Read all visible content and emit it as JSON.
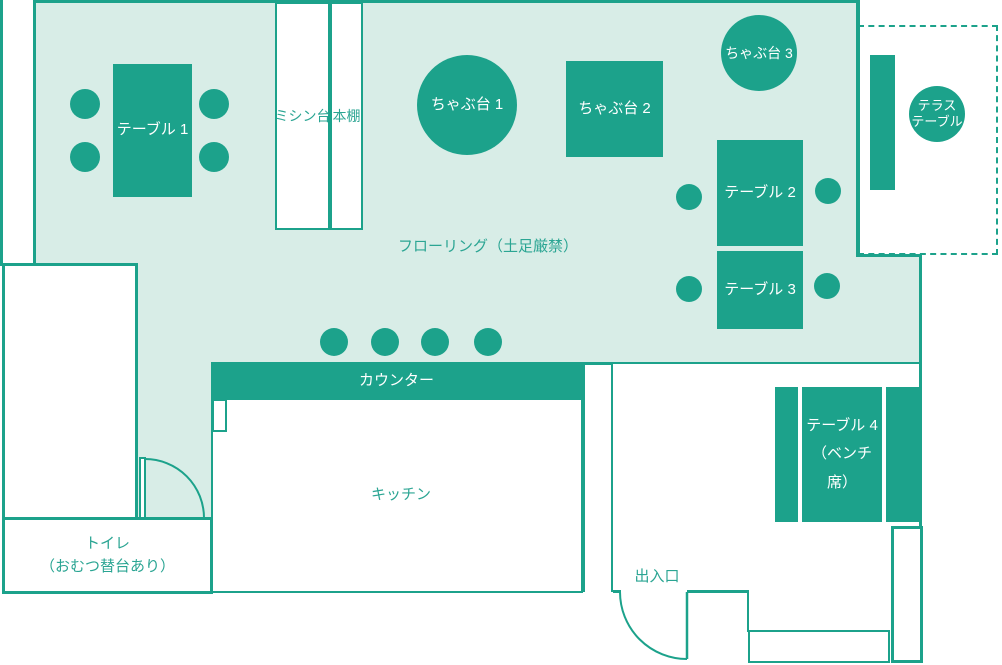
{
  "title": "店内レイアウト図",
  "colors": {
    "furniture_fill": "#1ca28b",
    "floor_fill": "#d8ede7",
    "wall_stroke": "#1ca28b",
    "teal_text": "#2ba593",
    "white_text": "#ffffff"
  },
  "rooms": {
    "flooring_label": "フローリング（土足厳禁）",
    "kitchen_label": "キッチン",
    "toilet_label_line1": "トイレ",
    "toilet_label_line2": "（おむつ替台あり）",
    "entrance_label": "出入口"
  },
  "furniture": {
    "table1": "テーブル 1",
    "table2": "テーブル 2",
    "table3": "テーブル 3",
    "table4_line1": "テーブル 4",
    "table4_line2": "（ベンチ席）",
    "chabudai1": "ちゃぶ台 1",
    "chabudai2": "ちゃぶ台 2",
    "chabudai3": "ちゃぶ台 3",
    "counter": "カウンター",
    "sewing_table": "ミシン台",
    "bookshelf": "本棚",
    "terrace_table_line1": "テラス",
    "terrace_table_line2": "テーブル"
  }
}
